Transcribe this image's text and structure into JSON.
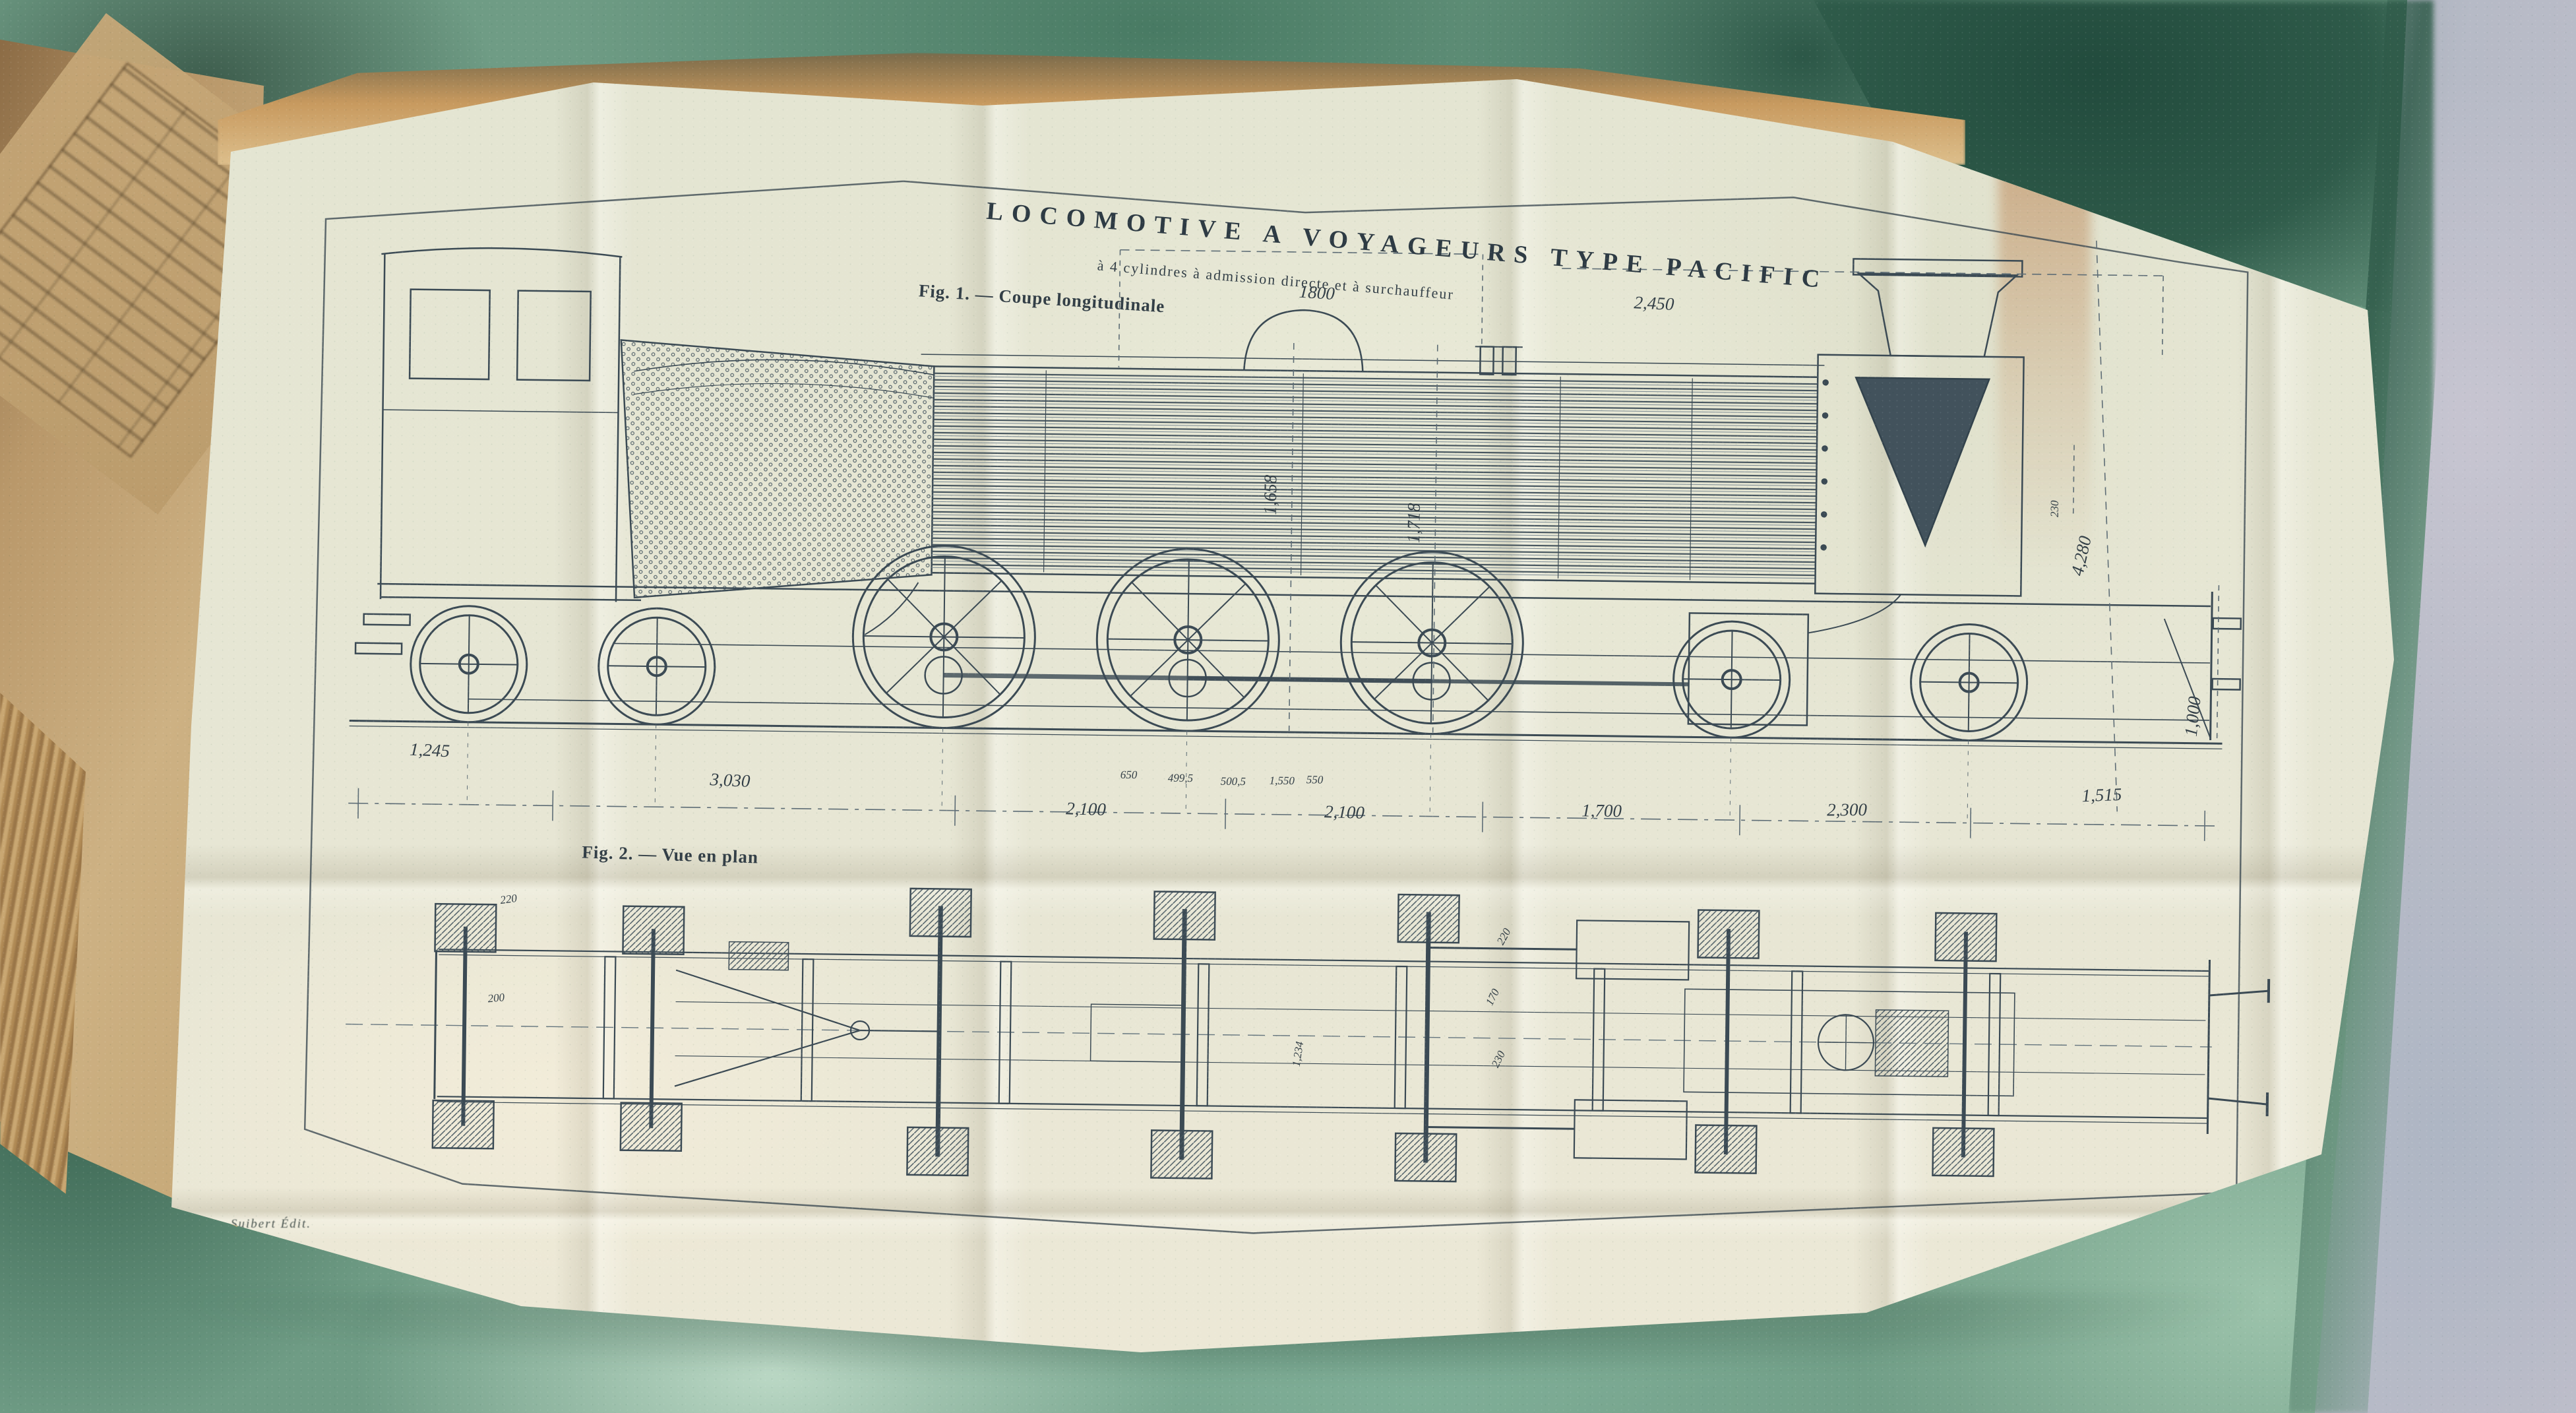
{
  "plate": {
    "title": "LOCOMOTIVE A VOYAGEURS TYPE PACIFIC",
    "subtitle": "à 4 cylindres à admission directe et à surchauffeur",
    "imprint": "Suibert Édit.",
    "fig1": {
      "caption": "Fig. 1. — Coupe longitudinale",
      "dim_top_1": "1800",
      "dim_top_2": "2,450",
      "dims_vertical": [
        "1,658",
        "1,718",
        "4,280",
        "230",
        "1,000"
      ],
      "dims_bottom": [
        "1,245",
        "3,030",
        "2,100",
        "2,100",
        "1,700",
        "2,300",
        "1,515"
      ],
      "dims_axle": [
        "650",
        "499,5",
        "500,5",
        "1,550",
        "550"
      ]
    },
    "fig2": {
      "caption": "Fig. 2. — Vue en plan",
      "dims": [
        "220",
        "200",
        "1,234",
        "220",
        "170",
        "230"
      ]
    }
  },
  "colors": {
    "paper": "#e6e6d4",
    "ink": "#3b4a54",
    "fabric_green": "#8fb9a2",
    "wall_grey": "#b6bac6",
    "page_tan": "#c9a772",
    "stain_brown": "#b5743f"
  }
}
